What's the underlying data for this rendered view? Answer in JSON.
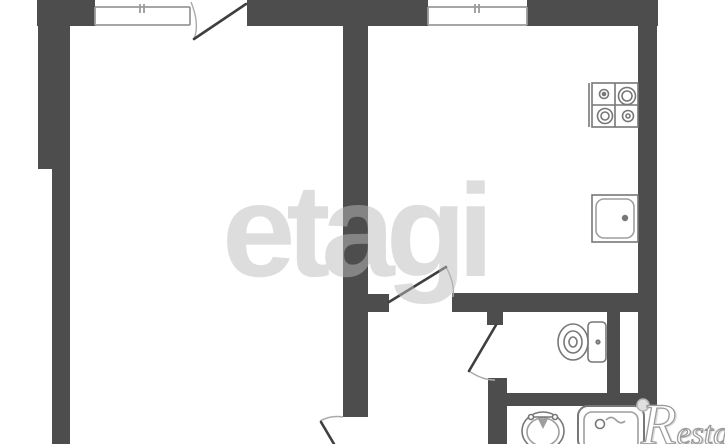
{
  "watermarks": {
    "center_brand": "etagi",
    "corner_brand_initial": "R",
    "corner_brand_rest": "estate"
  },
  "palette": {
    "background": "#ffffff",
    "wall": "#4d4d4d",
    "door_leaf": "#3f3f3f",
    "swing_arc": "#ababab",
    "window_stroke": "#9a9a9a",
    "fixture_stroke": "#777777",
    "fixture_stroke_light": "#9e9e9e",
    "watermark_center": "#bcbcbc",
    "watermark_corner_outline": "#9a9a9a",
    "logo_dot_fill": "#e0e0e0",
    "logo_dot_stroke": "#b5b5b5"
  },
  "fixture_icons": [
    "window-icon",
    "door-swing-icon",
    "stove-4-burner-icon",
    "kitchen-sink-icon",
    "toilet-icon",
    "washbasin-icon",
    "washing-machine-icon"
  ]
}
